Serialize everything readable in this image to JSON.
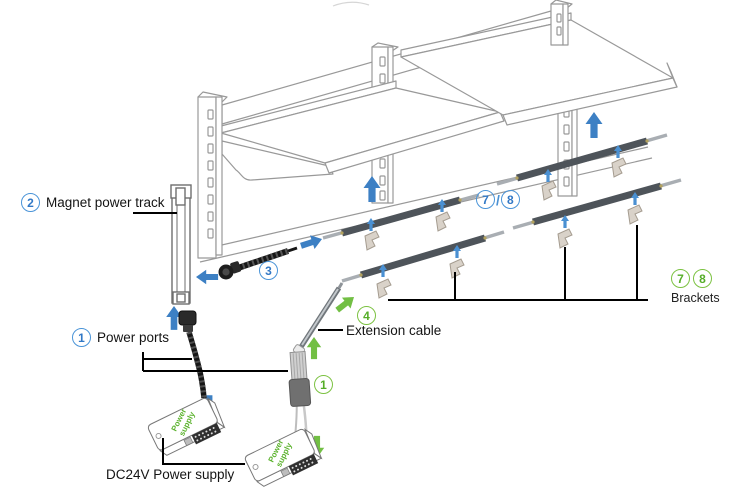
{
  "diagram_title": "magnet-track-shelving-installation-diagram",
  "labels": {
    "magnet_power_track": {
      "num": "2",
      "text": "Magnet power track"
    },
    "power_ports": {
      "num": "1",
      "text": "Power ports"
    },
    "track_connector": {
      "num": "3"
    },
    "tracks_pair": {
      "num_left": "7",
      "slash": "/",
      "num_right": "8"
    },
    "extension_cable": {
      "num": "4",
      "text": "Extension cable"
    },
    "power_port_connector": {
      "num": "1"
    },
    "brackets": {
      "num_left": "7",
      "num_right": "8",
      "text": "Brackets"
    },
    "dc_power": {
      "text": "DC24V Power supply"
    },
    "power_supply_box": {
      "line1": "Power",
      "line2": "supply"
    }
  },
  "colors": {
    "arrow_blue": "#3d80c4",
    "arrow_green": "#72bf44",
    "circle_blue": "#4a94d8",
    "circle_green": "#7cc242",
    "structure_gray": "#999999",
    "track_dark": "#4e545a",
    "label_black": "#141414"
  }
}
